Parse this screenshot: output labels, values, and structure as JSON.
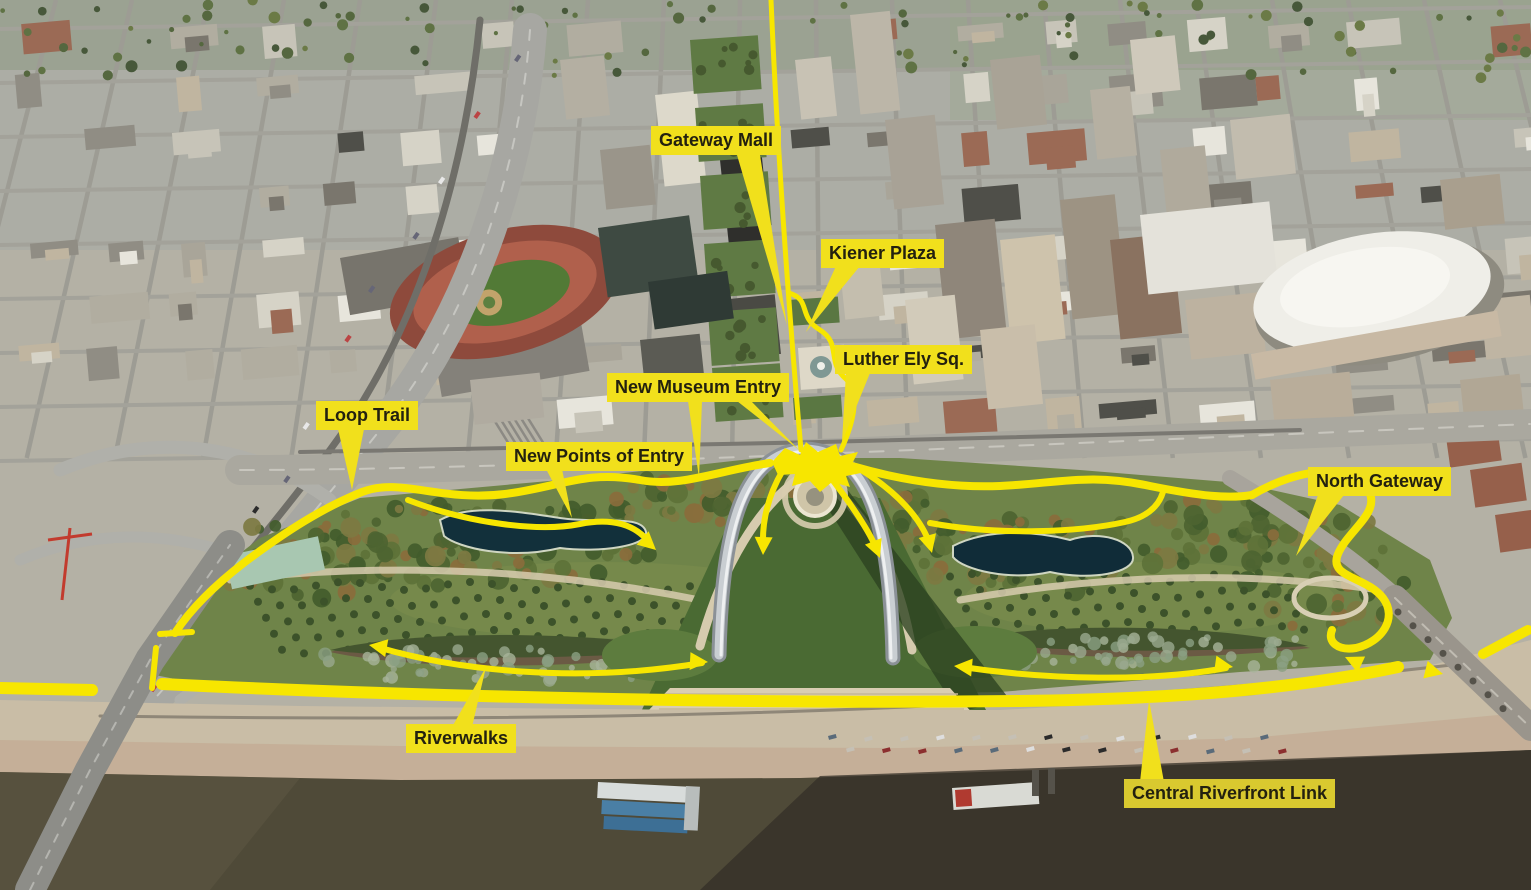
{
  "map": {
    "subject": "aerial-photo-annotated",
    "colors": {
      "annotation_yellow": "#f7e600",
      "label_background": "#f1e01c",
      "label_background_muted": "#d9c92f",
      "label_text": "#23210f"
    },
    "labels": [
      {
        "id": "gateway-mall",
        "text": "Gateway Mall"
      },
      {
        "id": "kiener-plaza",
        "text": "Kiener Plaza"
      },
      {
        "id": "luther-ely-sq",
        "text": "Luther Ely Sq."
      },
      {
        "id": "new-museum-entry",
        "text": "New Museum Entry"
      },
      {
        "id": "loop-trail",
        "text": "Loop Trail"
      },
      {
        "id": "new-points-of-entry",
        "text": "New Points of Entry"
      },
      {
        "id": "north-gateway",
        "text": "North Gateway"
      },
      {
        "id": "riverwalks",
        "text": "Riverwalks"
      },
      {
        "id": "central-riverfront-link",
        "text": "Central Riverfront Link"
      }
    ]
  }
}
